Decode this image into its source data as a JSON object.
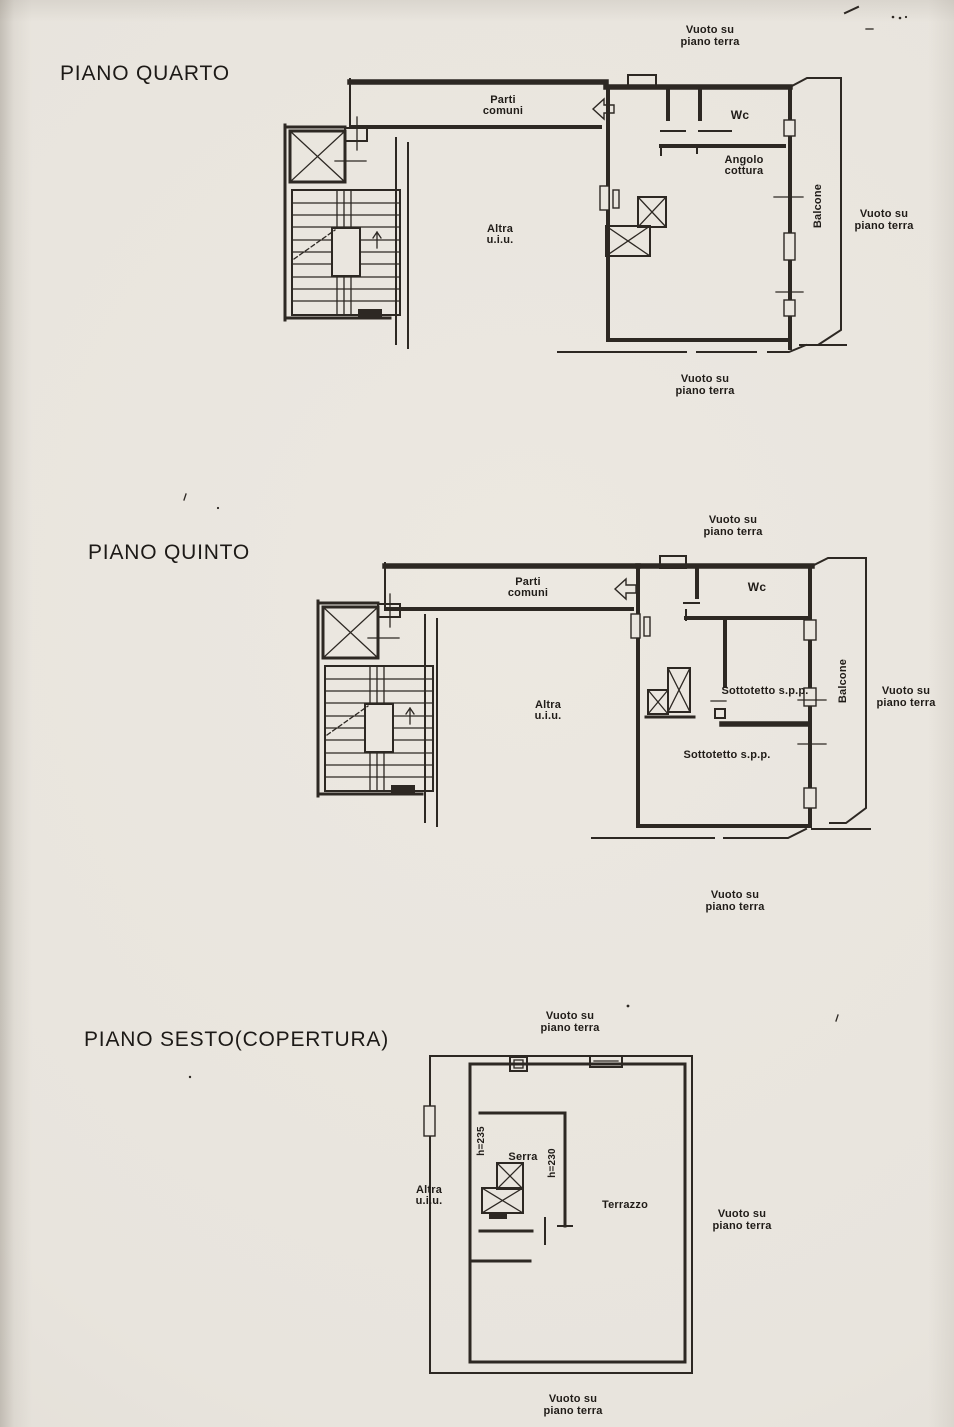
{
  "page": {
    "background_color": "#eae6df",
    "ink_color": "#2d2823"
  },
  "shared": {
    "vuoto_line1": "Vuoto su",
    "vuoto_line2": "piano terra",
    "parti_line1": "Parti",
    "parti_line2": "comuni",
    "wc": "Wc",
    "altra_line1": "Altra",
    "altra_line2": "u.i.u.",
    "balcone": "Balcone"
  },
  "plans": {
    "quarto": {
      "title": "PIANO QUARTO",
      "angolo_line1": "Angolo",
      "angolo_line2": "cottura"
    },
    "quinto": {
      "title": "PIANO QUINTO",
      "sottotetto_upper": "Sottotetto s.p.p.",
      "sottotetto_lower": "Sottotetto s.p.p."
    },
    "sesto": {
      "title": "PIANO SESTO(COPERTURA)",
      "serra": "Serra",
      "height_serra": "h=235",
      "height_wall": "h=230",
      "terrazzo": "Terrazzo"
    }
  }
}
